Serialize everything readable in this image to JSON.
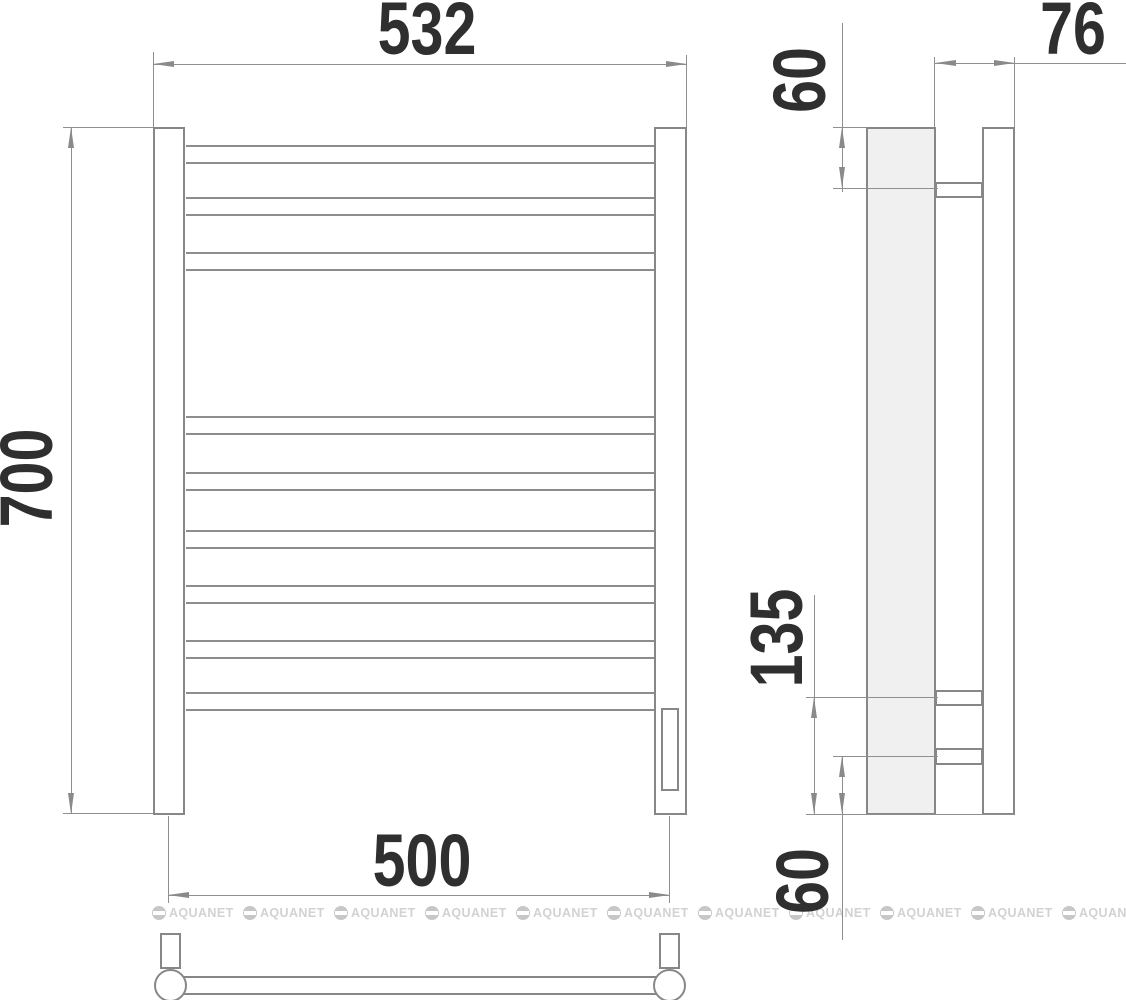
{
  "drawing": {
    "type": "towel-rail technical drawing, front / side / bottom views",
    "dimensions": {
      "front_width": "532",
      "front_height": "700",
      "bottom_width": "500",
      "side_depth": "76",
      "side_top_offset": "60",
      "side_bracket_span": "135",
      "side_bottom_offset": "60"
    },
    "watermark": {
      "text": "AQUANET"
    },
    "colors": {
      "outline": "#878787",
      "dimension_line": "#8f8f8f",
      "label_text": "#2f2f2f",
      "side_post_fill": "#f0f0f0",
      "watermark": "#d2d2d2"
    }
  }
}
